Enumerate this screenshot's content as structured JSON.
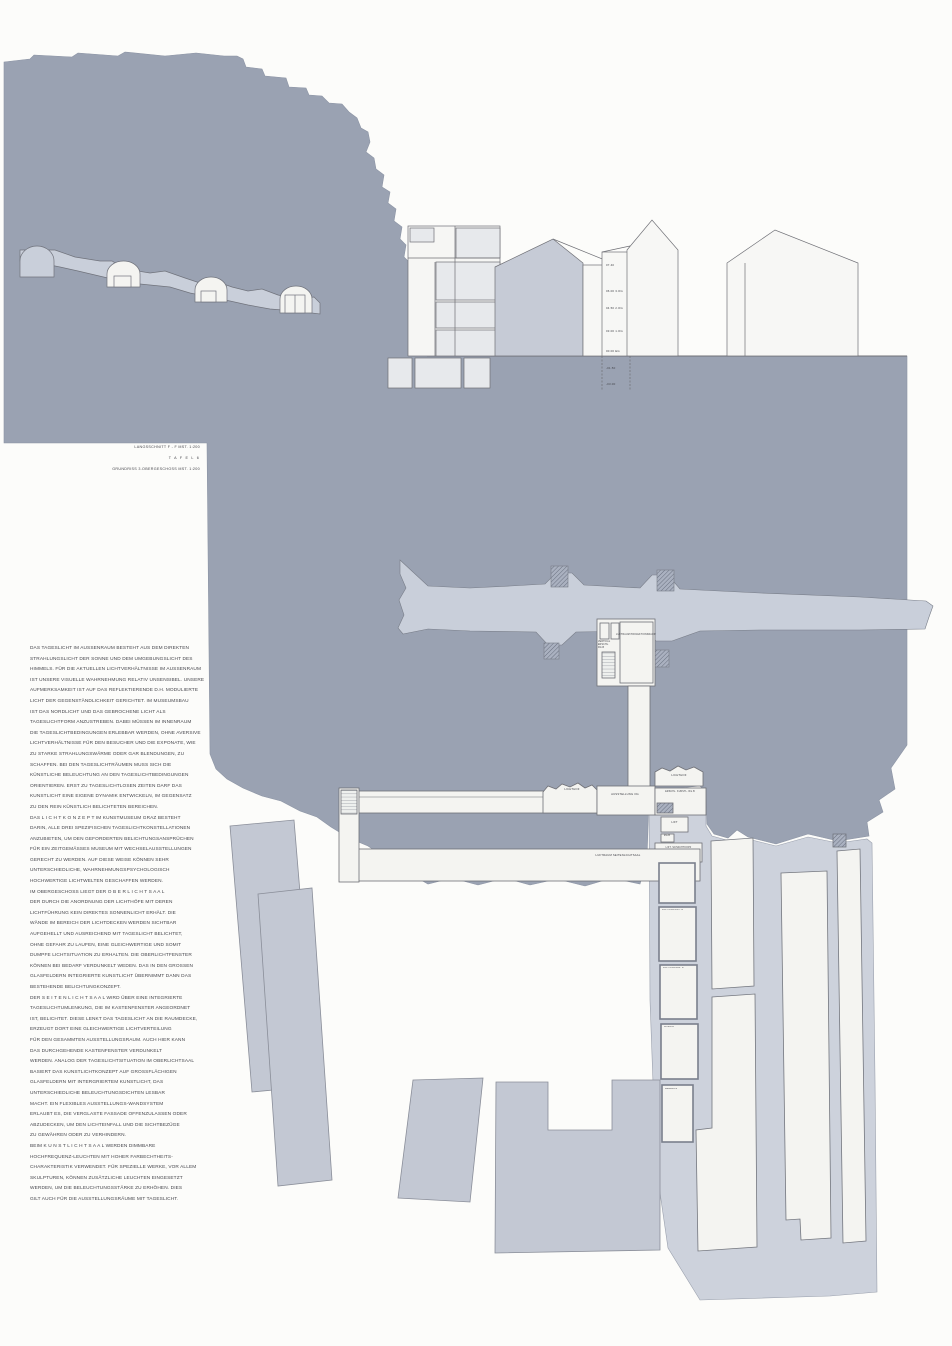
{
  "title_block": {
    "line1": "LANGSSCHNITT F - F  MST. 1:200",
    "line2": "T A F E L   6",
    "line3": "GRUNDRISS 3.OBERGESCHOSS  MST. 1:200"
  },
  "text_block": {
    "lines": [
      "DAS TAGESLICHT IM AUSSENRAUM BESTEHT AUS DEM DIREKTEN",
      "STRAHLUNGSLICHT DER SONNE UND DEM UMGEBUNGSLICHT DES",
      "HIMMELS. FÜR DIE AKTUELLEN LICHTVERHÄLTNISSE IM AUSSENRAUM",
      "IST UNSERE VISUELLE WAHRNEHMUNG RELATIV UNSENSIBEL. UNSERE",
      "AUFMERKSAMKEIT IST AUF DAS REFLEKTIERENDE D.H. MODULIERTE",
      "LICHT DER GEGENSTÄNDLICHKEIT GERICHTET. IM MUSEUMSBAU",
      "IST DAS NORDLICHT UND DAS GEBROCHENE LICHT ALS",
      "TAGESLICHTFORM ANZUSTREBEN. DABEI MÜSSEN IM INNENRAUM",
      "DIE TAGESLICHTBEDINGUNGEN ERLEBBAR WERDEN, OHNE AVERSIVE",
      "LICHTVERHÄLTNISSE FÜR DEN BESUCHER UND DIE EXPONATE, WIE",
      "ZU STARKE STRAHLUNGSWÄRME ODER GAR BLENDUNGEN, ZU",
      "SCHAFFEN. BEI DEN TAGESLICHTRÄUMEN MUSS SICH DIE",
      "KÜNSTLICHE BELEUCHTUNG AN DEN TAGESLICHTBEDINGUNGEN",
      "ORIENTIEREN. ERST ZU TAGESLICHTLOSEN ZEITEN DARF DAS",
      "KUNSTLICHT EINE EIGENE DYNAMIK ENTWICKELN, IM GEGENSATZ",
      "ZU DEN REIN KÜNSTLICH BELICHTETEN BEREICHEN.",
      "DAS  L I C H T K O N Z E P T   IM KUNSTMUSEUM GRAZ BESTEHT",
      "DARIN, ALLE DREI SPEZIFISCHEN TAGESLICHTKONSTELLATIONEN",
      "ANZUBIETEN, UM DEN GEFORDERTEN BELICHTUNGSANSPRÜCHEN",
      "FÜR EIN ZEITGEMÄSSES MUSEUM MIT WECHSELAUSSTELLUNGEN",
      "GERECHT ZU WERDEN. AUF DIESE WEISE KÖNNEN SEHR",
      "UNTERSCHIEDLICHE, WAHRNEHMUNGSPSYCHOLOGISCH",
      "HOCHWERTIGE LICHTWELTEN GESCHAFFEN WERDEN.",
      "IM OBERGESCHOSS LIEGT DER   O B E R L I C H T S A A L",
      "DER DURCH DIE ANORDNUNG DER LICHTHÖFE MIT DEREN",
      "LICHTFÜHRUNG  KEIN DIREKTES SONNENLICHT ERHÄLT. DIE",
      "WÄNDE IM BEREICH DER LICHTDECKEN WERDEN SICHTBAR",
      "AUFGEHELLT UND AUSREICHEND MIT TAGESLICHT BELICHTET,",
      "OHNE GEFAHR ZU LAUFEN, EINE GLEICHWERTIGE UND SOMIT",
      "DUMPFE LICHTSITUATION ZU ERHALTEN. DIE OBERLICHTFENSTER",
      "KÖNNEN BEI BEDARF VERDUNKELT WEDEN. DAS IN DEN GROSSEN",
      "GLASFELDERN INTEGRIERTE KUNSTLICHT ÜBERNIMMT DANN DAS",
      "BESTEHENDE BELICHTUNGKONZEPT.",
      "DER  S E I T E N L I C H T S A A L   WIRD ÜBER EINE INTEGRIERTE",
      "TAGESLICHTUMLENKUNG, DIE IM KASTENFENSTER ANGEORDNET",
      "IST, BELICHTET. DIESE LENKT DAS TAGESLICHT AN DIE RAUMDECKE,",
      "ERZEUGT DORT EINE GLEICHWERTIGE LICHTVERTEILUNG",
      "FÜR DEN GESAMMTEN AUSSTELLUNGSRAUM. AUCH HIER KANN",
      "DAS DURCHGEHENDE KASTENFENSTER VERDUNKELT",
      "WERDEN. ANALOG DER TAGESLICHTSITUATION IM OBERLICHTSAAL",
      "BASIERT DAS KUNSTLICHTKONZEPT AUF GROSSFLÄCHIGEN",
      "GLASFELDERN MIT INTERGRIERTEM KUNSTLICHT, DAS",
      "UNTERSCHIEDLICHE BELEUCHTUNGSDICHTEN LESBAR",
      "MACHT. EIN FLEXIBLES AUSSTELLUNGS-WANDSYSTEM",
      "ERLAUBT ES, DIE VERGLASTE FASSADE OFFENZULASSEN ODER",
      "ABZUDECKEN, UM DEN LICHTEINFALL UND DIE SICHTBEZÜGE",
      "ZU GEWÄHREN ODER ZU VERHINDERN.",
      "BEIM  K U N S T L I C H T S A A L   WERDEN DIMMBARE",
      "HOCHFREQUENZ-LEUCHTEN MIT HOHER FARBECHTHEITS-",
      "CHARAKTERISTIK VERWENDET. FÜR SPEZIELLE WERKE, VOR ALLEM",
      "SKULPTUREN, KÖNNEN ZUSÄTZLICHE LEUCHTEN EINGESETZT",
      "WERDEN, UM DIE BELEUCHTUNGSSTÄRKE ZU ERHÖHEN. DIES",
      "GILT AUCH FÜR DIE AUSSTELLUNGSRÄUME MIT TAGESLICHT."
    ]
  },
  "section": {
    "levels": [
      "07.40",
      "06.00  3.OG",
      "04.50  2.OG",
      "03.00  1.OG",
      "00.00  EG",
      "-01.50",
      "-03.00"
    ]
  },
  "plan": {
    "labels": {
      "lichthof_left": "LICHTHOF",
      "ausstellung": "AUSSTELLUNG OG",
      "lichthof_right": "LICHTHOF",
      "erschliessung": "ERSCHL. KUNSTL. RG.B",
      "lift": "LIFT",
      "rgb": "RG.B",
      "schachtkopf": "LIFT. SCHACHTKOPF",
      "luftraum_seitenlichtsaal": "LUFTRAUM SEITENLICHTSAAL",
      "vertikal_erschliessung": "VERTIKAL ERSCHL. RG.B",
      "luftraum_projektionsraum": "LUFTRAUM PROJEKTIONSRAUM"
    },
    "shaft_labels": [
      "LÜFTUNG MGT. B",
      "LÜFTUNG ABL. B",
      "KLIMA B",
      "MEDIEN B"
    ]
  },
  "colors": {
    "hill": "#9aa2b2",
    "mid_grey": "#c3c8d3",
    "light_grey": "#cad0da",
    "room_white": "#f4f4f1",
    "outline": "#6f7076"
  }
}
